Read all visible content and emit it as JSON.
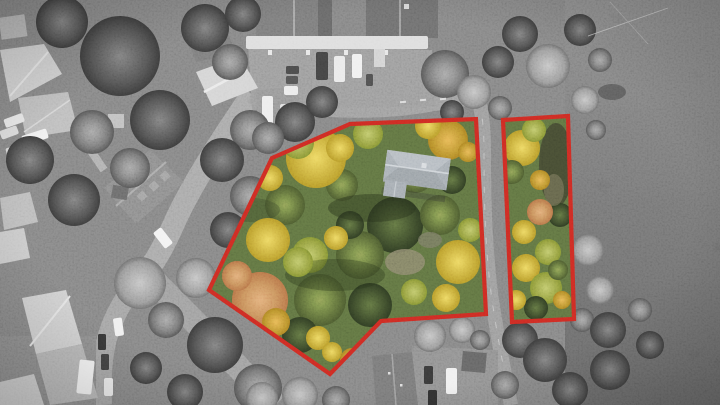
{
  "scene": {
    "description": "Aerial drone photograph; neighborhood desaturated to grayscale with two for-sale wooded lots shown in autumn color and outlined in red; gray-roofed house on the main lot; road between the lots; open field at right"
  },
  "overlay": {
    "parcels": [
      {
        "id": "main-lot",
        "points": "272,158 350,124 476,119 486,314 381,321 330,374 209,290"
      },
      {
        "id": "side-lot",
        "points": "503,120 568,116 574,319 512,322"
      }
    ]
  },
  "colors": {
    "boundary-red": "#c4261f",
    "parcel-base-green": "#55663a",
    "house-roof-light": "#aab1b8",
    "house-roof-dark": "#8b9399",
    "autumn-yellow-light": "#ead157",
    "autumn-yellow-deep": "#aa8825",
    "autumn-gold-light": "#e3ab4c",
    "autumn-gold-deep": "#9f731f",
    "autumn-orange-light": "#dda06c",
    "autumn-orange-deep": "#aa6740",
    "autumn-green-light": "#7f914d",
    "autumn-green-deep": "#43502a",
    "autumn-darkgreen-light": "#57683b",
    "autumn-darkgreen-deep": "#2a351f",
    "autumn-lime-light": "#b5bf60",
    "autumn-lime-deep": "#74812e"
  }
}
